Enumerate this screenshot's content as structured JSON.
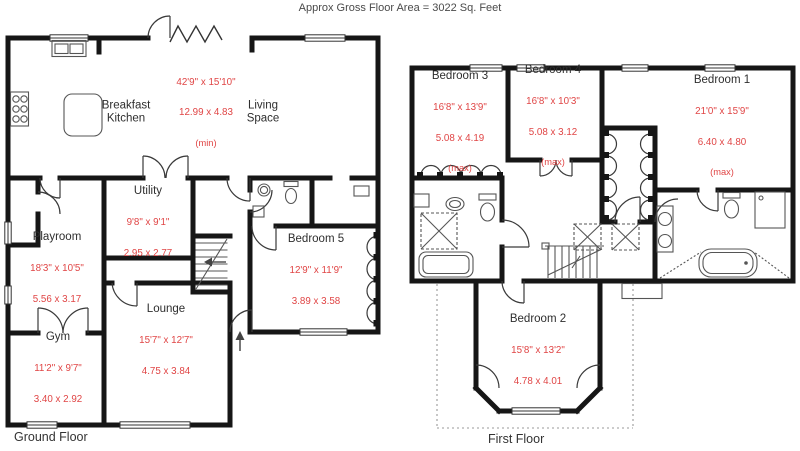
{
  "header": {
    "title": "Approx Gross Floor Area  =  3022  Sq. Feet"
  },
  "colors": {
    "wall": "#161616",
    "dims_red": "#e04545",
    "label": "#2e2e2e"
  },
  "floors": [
    {
      "label": "Ground Floor",
      "rooms": [
        {
          "id": "breakfast-kitchen",
          "name": "Breakfast Kitchen"
        },
        {
          "id": "kitchen-living-area-dims",
          "dims_ft": "42'9\" x 15'10\"",
          "dims_m": "12.99 x  4.83",
          "note": "(min)"
        },
        {
          "id": "living-space",
          "name": "Living Space"
        },
        {
          "id": "utility",
          "name": "Utility",
          "dims_ft": "9'8\"  x  9'1\"",
          "dims_m": "2.95  x  2.77"
        },
        {
          "id": "playroom",
          "name": "Playroom",
          "dims_ft": "18'3\" x 10'5\"",
          "dims_m": "5.56  x  3.17"
        },
        {
          "id": "gym",
          "name": "Gym",
          "dims_ft": "11'2\" x  9'7\"",
          "dims_m": "3.40  x  2.92"
        },
        {
          "id": "lounge",
          "name": "Lounge",
          "dims_ft": "15'7\" x 12'7\"",
          "dims_m": "4.75  x  3.84"
        },
        {
          "id": "bedroom-5",
          "name": "Bedroom 5",
          "dims_ft": "12'9\" x 11'9\"",
          "dims_m": "3.89  x  3.58"
        }
      ]
    },
    {
      "label": "First Floor",
      "rooms": [
        {
          "id": "bedroom-3",
          "name": "Bedroom 3",
          "dims_ft": "16'8\" x 13'9\"",
          "dims_m": "5.08  x  4.19",
          "note": "(max)"
        },
        {
          "id": "bedroom-4",
          "name": "Bedroom 4",
          "dims_ft": "16'8\" x 10'3\"",
          "dims_m": "5.08  x  3.12",
          "note": "(max)"
        },
        {
          "id": "bedroom-1",
          "name": "Bedroom 1",
          "dims_ft": "21'0\" x 15'9\"",
          "dims_m": "6.40  x  4.80",
          "note": "(max)"
        },
        {
          "id": "bedroom-2",
          "name": "Bedroom 2",
          "dims_ft": "15'8\" x 13'2\"",
          "dims_m": "4.78  x  4.01"
        }
      ]
    }
  ]
}
